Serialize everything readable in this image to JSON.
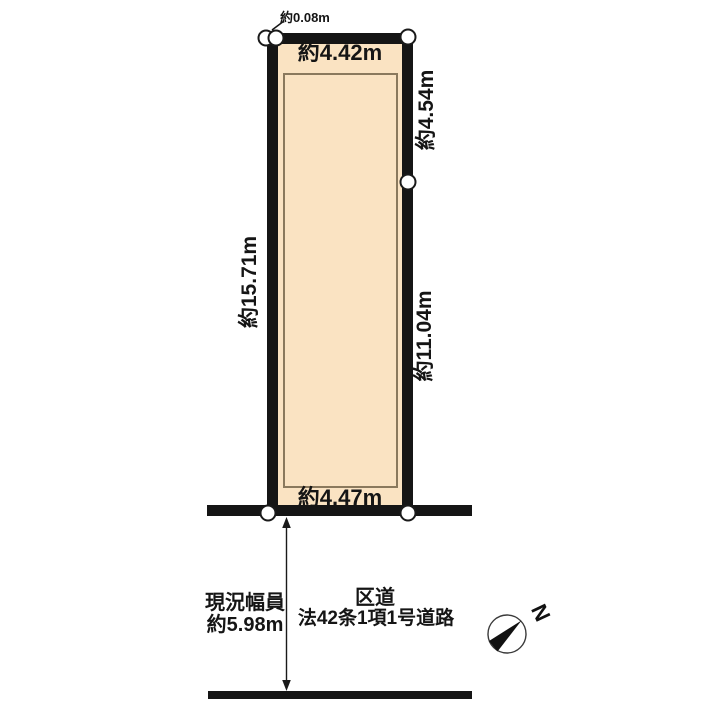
{
  "diagram": {
    "type": "land-plot-survey-diagram",
    "colors": {
      "plot_fill": "#FAE3C2",
      "line": "#151515",
      "inner_outline": "#8a795d",
      "background": "#ffffff"
    },
    "plot": {
      "labels": {
        "offset_top": "約0.08m",
        "top_width": "約4.42m",
        "left_depth": "約15.71m",
        "right_upper_depth": "約4.54m",
        "right_lower_depth": "約11.04m",
        "bottom_width": "約4.47m"
      }
    },
    "road": {
      "width_caption_line1": "現況幅員",
      "width_caption_line2": "約5.98m",
      "name_caption_line1": "区道",
      "name_caption_line2": "法42条1項1号道路"
    },
    "compass": {
      "north_label": "N"
    }
  }
}
